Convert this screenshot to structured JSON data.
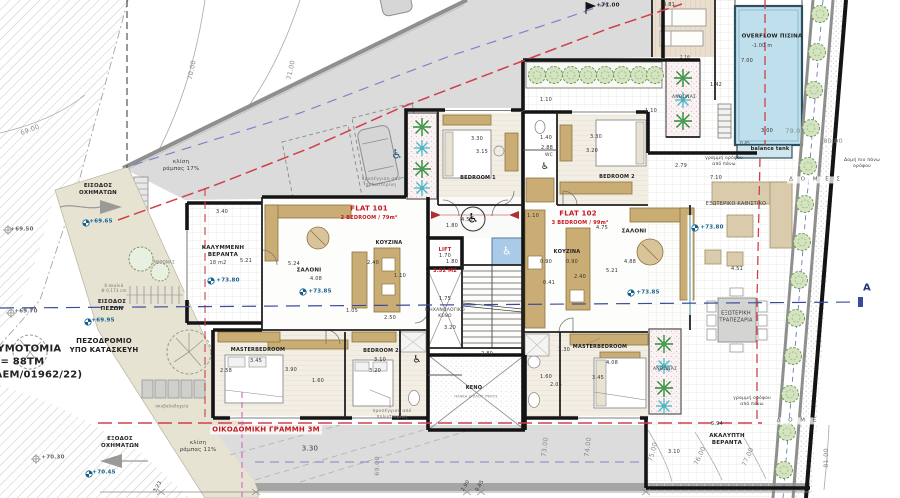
{
  "site": {
    "vehicle_entrance": "ΕΙΣΟΔΟΣ\nΟΧΗΜΑΤΩΝ",
    "vehicle_exit": "ΕΞΟΔΟΣ\nΟΧΗΜΑΤΩΝ",
    "pedestrian_entrance": "ΕΙΣΟΔΟΣ\nΠΕΖΩΝ",
    "sidewalk": "ΠΕΖΟΔΡΟΜΙΟ\nΥΠΟ ΚΑΤΑΣΚΕΥΗ",
    "plot_note": "ΡΥΜΟΤΟΜΙΑ\nΕ = 88ΤΜ\n(ΛΕΜ/01962/22)",
    "building_line": "ΟΙΚΟΔΟΜΙΚΗ ΓΡΑΜΜΗ 3Μ",
    "ramp_slope_17": "κλίση\nράμπας 17%",
    "ramp_slope_11": "κλίση\nράμπας 11%",
    "dim_330": "3.30",
    "floor_line_above_a": "γραμμή ορόφου\nαπό πάνω",
    "floor_line_above_b": "γραμμή ορόφου\nαπό πάνω",
    "structure_above": "Δομή πιο πάνω\nορόφου",
    "domes_a": "Δ Ο Μ Ε Σ",
    "domes_b": "Δ Ο Μ Ε",
    "section_letter": "A",
    "steps_note": "8 σκαλιά\nΦ 0,173 cm",
    "bins_note": "σκυβαλοδοχεία",
    "insulation_note_a": "προσέγγιση από\nπολυστερίνη",
    "insulation_note_b": "προσέγγιση από\nπολυστερίνη"
  },
  "levels": {
    "a": "+69.50",
    "b": "+69.65",
    "c": "+69.70",
    "d": "+69.95",
    "e": "+70.30",
    "f": "+70.45",
    "g": "+71.00"
  },
  "contours": {
    "c69a": "69.00",
    "c70": "70.00",
    "c71": "71.00",
    "c69b": "69.00",
    "c73": "73.00",
    "c74": "74.00",
    "c75": "75.00",
    "c76": "76.00",
    "c77": "77.00",
    "c79": "79.00",
    "c80": "80.00",
    "c81": "81.00"
  },
  "pool": {
    "name": "OVERFLOW ΠΙΣΙΝΑ",
    "depth": "-1.00 m",
    "length": "7.00",
    "width": "3.00",
    "tank": "balance tank",
    "tank_width": "0.45"
  },
  "outdoor": {
    "deck_width": "4.81",
    "deck_depth": "2.16",
    "planter_top": "ΑΝΘΩΝΑΣ",
    "planter_east": "ΑΝΘΩΝΑΣ",
    "planter_garden": "ΑΝΘΩΝΑΣ",
    "walk_a": "1.10",
    "walk_b": "1.10",
    "walk_c": "1.42",
    "dim_279": "2.79",
    "dim_710": "7.10",
    "seating": "ΕΞΩΤΕΡΙΚΟ ΚΑΘΙΣΤΙΚΟ",
    "seating_level": "+73.80",
    "dim_451": "4.51",
    "dining": "ΕΞΩΤΕΡΙΚΗ\nΤΡΑΠΕΖΑΡΙΑ",
    "open_veranda": "ΑΚΑΛΥΠΤΗ\nΒΕΡΑΝΤΑ",
    "dim_594": "5.94",
    "dim_310": "3.10"
  },
  "flat101": {
    "title": "FLAT 101",
    "subtitle": "2 BEDROOM / 79m²",
    "level": "+73.85",
    "veranda": "ΚΑΛΥΜΜΕΝΗ\nΒΕΡΑΝΤΑ",
    "veranda_area": "18 m2",
    "veranda_level": "+73.80",
    "dim_340": "3.40",
    "dim_521": "5.21",
    "living": "ΣΑΛΟΝΙ",
    "dim_408": "4.08",
    "dim_524": "5.24",
    "kitchen": "ΚΟΥΖΙΝΑ",
    "dim_240": "2.40",
    "dim_110": "1.10",
    "dim_250": "2.50",
    "dim_105": "1.05",
    "master": "MASTERBEDROOM",
    "dim_345": "3.45",
    "dim_390": "3.90",
    "dim_258": "2.58",
    "dim_160": "1.60",
    "bedroom2": "BEDROOM 2",
    "dim_b310": "3.10",
    "dim_b320": "3.20"
  },
  "flat102": {
    "title": "FLAT 102",
    "subtitle": "3 BEDROOM / 99m²",
    "level": "+73.85",
    "bedroom1": "BEDROOM 1",
    "dim_330": "3.30",
    "dim_315": "3.15",
    "bedroom2": "BEDROOM 2",
    "dim_b330": "3.30",
    "dim_b320": "3.20",
    "wc": "WC",
    "dim_140": "1.40",
    "dim_288": "2.88",
    "dim_110": "1.10",
    "dim_475": "4.75",
    "kitchen": "ΚΟΥΖΙΝΑ",
    "dim_090a": "0.90",
    "dim_090b": "0.90",
    "dim_240": "2.40",
    "dim_041": "0.41",
    "living": "ΣΑΛΟΝΙ",
    "dim_488": "4.88",
    "dim_521": "5.21",
    "master": "MASTERBEDROOM",
    "dim_130": "1.30",
    "dim_408": "4.08",
    "dim_345": "3.45",
    "dim_205": "2.05",
    "dim_160": "1.60"
  },
  "core": {
    "lift": "LIFT",
    "lift_area": "3.52 M2",
    "lift_w": "1.70",
    "lift_d": "1.80",
    "hall_w": "4.55",
    "hall_d": "1.80",
    "mech_void": "ΜΗΧΑΝΟΛΟΓΙΚΟ\nΚΕΝΟ",
    "mech_w": "1.75",
    "mech_h": "3.20",
    "stair_w": "2.80",
    "void": "ΚΕΝΟ",
    "void_note": "ΠΛΑΚΑ ΔΙΠΛΟΥ ΥΨΟΥΣ"
  },
  "bottom_dims": {
    "a": "3.23",
    "b": "2.90",
    "c": "0.85"
  },
  "icons": {
    "wheelchair": "♿"
  },
  "colors": {
    "accent_red": "#c4161c",
    "pool_blue": "#bfdfec",
    "level_blue": "#11608e",
    "section_navy": "#27327e",
    "road_gray": "#dbdbdb",
    "wall_black": "#141414",
    "wood_tan": "#c9ad74",
    "green": "#4f9a48"
  }
}
